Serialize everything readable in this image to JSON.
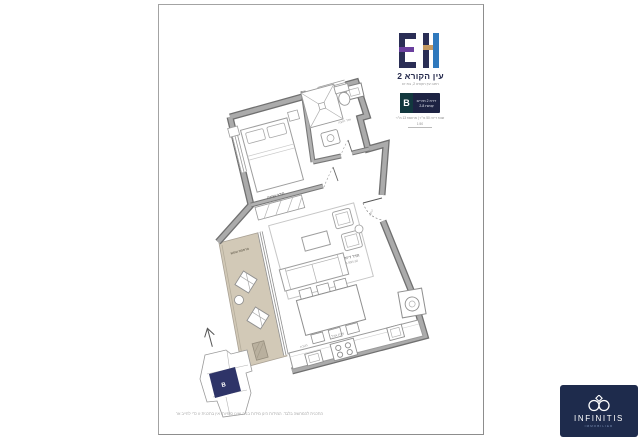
{
  "header": {
    "logo_letters": "EH",
    "project_title": "עין הקורא 2",
    "project_subtitle": "רחוב עין הקורא 2, בת ים",
    "badge": {
      "unit": "B",
      "line1": "דירת 2 חדרים",
      "line2": "קומות 2-8"
    },
    "meta_line": "שטח דירה 50 מ״ר | מרפסת 13 מ״ר",
    "scale_label": "1:50"
  },
  "plan": {
    "rooms": {
      "bedroom": {
        "label": "חדר שינה",
        "dims": "3.10/3.80"
      },
      "bathroom": {
        "label": "חדר רחצה"
      },
      "living": {
        "label": "חדר דיור",
        "dims": "3.90/5.60"
      },
      "dining": {
        "label": "פינת אוכל"
      },
      "kitchen": {
        "label": "מטבח"
      },
      "balcony": {
        "label": "מרפסת שמש"
      },
      "entrance": {
        "label": "כניסה"
      }
    }
  },
  "keyplan": {
    "highlight_unit": "B"
  },
  "disclaimer": "התכנית להמחשה בלבד. המידות הינן מידות בניה ואינן סופיות. אין בתכנית זו כדי לחייב את החברה.",
  "branding": {
    "name": "INFINITIS",
    "tagline": "IMMOBILIER"
  },
  "colors": {
    "navy": "#262b4d",
    "purple": "#6a3f9e",
    "blue": "#2f79bd",
    "tan": "#c59a62",
    "badge_bg": "#1d2343",
    "badge_unit_bg": "#12383e",
    "brand_bg": "#1e2b4c",
    "balcony_floor": "#d2c9b7",
    "wall_dark": "#707070",
    "wall_light": "#ababab",
    "keyplan_unit": "#2e3468"
  }
}
